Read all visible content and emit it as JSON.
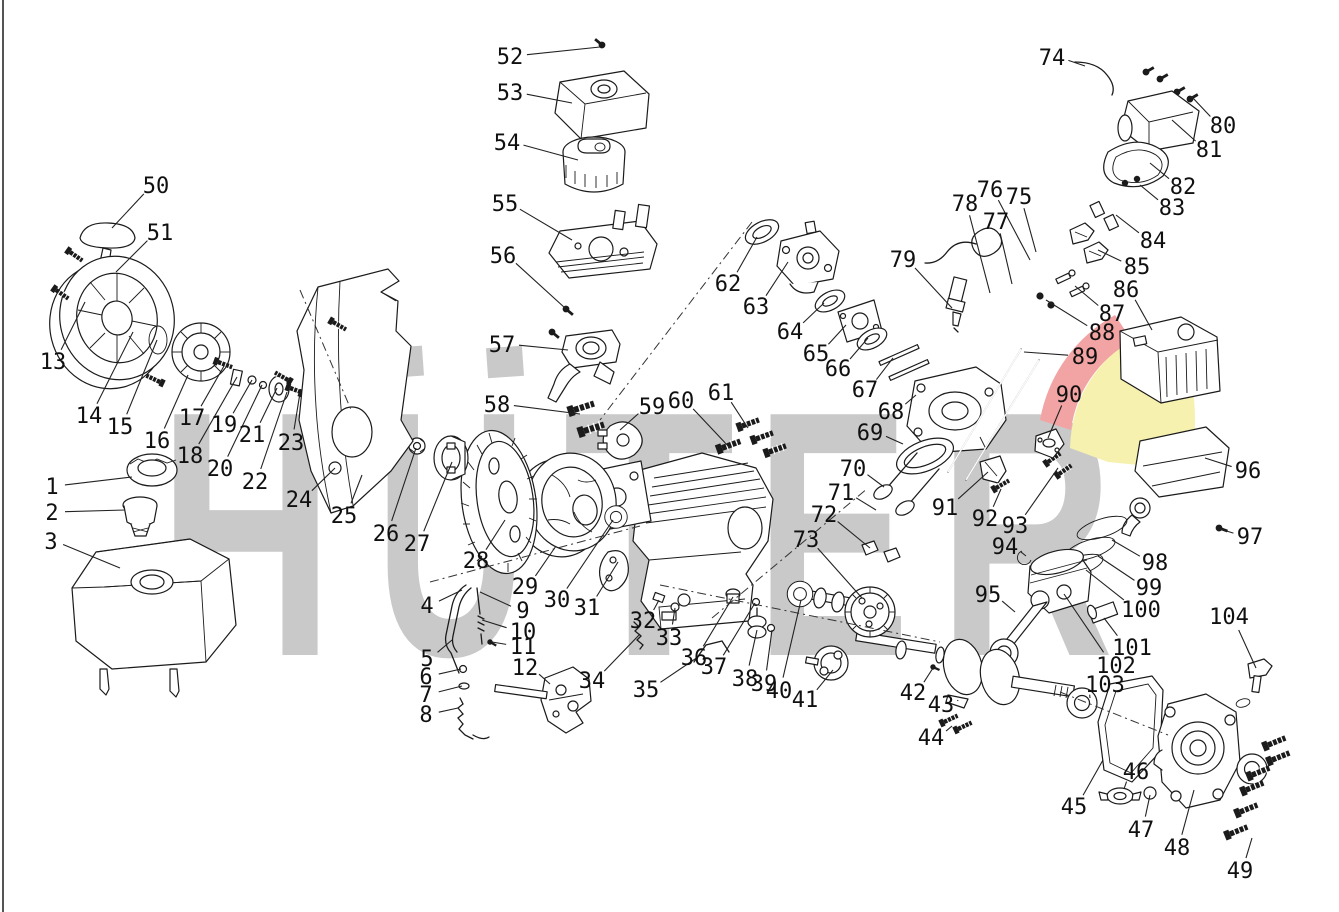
{
  "figure": {
    "type": "exploded-parts-diagram",
    "subject": "engine exploded view with numbered callouts",
    "background": "#ffffff",
    "line_color": "#1b1b1b"
  },
  "watermark": {
    "brand": "HÜTER",
    "letters": [
      "H",
      "U",
      "T",
      "E",
      "R"
    ],
    "letter_color": "#c9c9c9",
    "swoosh_red": "#f2a3a3",
    "swoosh_yellow": "#f6f1ae"
  },
  "diagram": {
    "axis_lines": [
      [
        300,
        290,
        352,
        412
      ],
      [
        752,
        222,
        600,
        420
      ],
      [
        712,
        618,
        868,
        488
      ],
      [
        660,
        585,
        940,
        642
      ],
      [
        1060,
        692,
        1168,
        735
      ],
      [
        430,
        582,
        640,
        526
      ]
    ],
    "callouts": [
      {
        "n": "1",
        "x": 52,
        "y": 486,
        "tx": 132,
        "ty": 477
      },
      {
        "n": "2",
        "x": 52,
        "y": 512,
        "tx": 125,
        "ty": 510
      },
      {
        "n": "3",
        "x": 51,
        "y": 541,
        "tx": 120,
        "ty": 568
      },
      {
        "n": "4",
        "x": 427,
        "y": 605,
        "tx": 462,
        "ty": 590
      },
      {
        "n": "5",
        "x": 427,
        "y": 658,
        "tx": 452,
        "ty": 640
      },
      {
        "n": "6",
        "x": 426,
        "y": 676,
        "tx": 461,
        "ty": 669
      },
      {
        "n": "7",
        "x": 426,
        "y": 694,
        "tx": 462,
        "ty": 686
      },
      {
        "n": "8",
        "x": 426,
        "y": 714,
        "tx": 458,
        "ty": 708
      },
      {
        "n": "9",
        "x": 523,
        "y": 610,
        "tx": 480,
        "ty": 592
      },
      {
        "n": "10",
        "x": 523,
        "y": 631,
        "tx": 482,
        "ty": 620
      },
      {
        "n": "11",
        "x": 523,
        "y": 646,
        "tx": 492,
        "ty": 642
      },
      {
        "n": "12",
        "x": 525,
        "y": 667,
        "tx": 550,
        "ty": 684
      },
      {
        "n": "13",
        "x": 53,
        "y": 361,
        "tx": 85,
        "ty": 302
      },
      {
        "n": "14",
        "x": 89,
        "y": 415,
        "tx": 133,
        "ty": 332
      },
      {
        "n": "15",
        "x": 120,
        "y": 426,
        "tx": 157,
        "ty": 340
      },
      {
        "n": "16",
        "x": 157,
        "y": 440,
        "tx": 188,
        "ty": 375
      },
      {
        "n": "17",
        "x": 192,
        "y": 417,
        "tx": 224,
        "ty": 366
      },
      {
        "n": "18",
        "x": 190,
        "y": 455,
        "tx": 237,
        "ty": 377
      },
      {
        "n": "19",
        "x": 224,
        "y": 424,
        "tx": 252,
        "ty": 380
      },
      {
        "n": "20",
        "x": 220,
        "y": 468,
        "tx": 262,
        "ty": 385
      },
      {
        "n": "21",
        "x": 252,
        "y": 434,
        "tx": 277,
        "ty": 388
      },
      {
        "n": "22",
        "x": 255,
        "y": 481,
        "tx": 287,
        "ty": 392
      },
      {
        "n": "23",
        "x": 291,
        "y": 442,
        "tx": 300,
        "ty": 393
      },
      {
        "n": "24",
        "x": 299,
        "y": 499,
        "tx": 335,
        "ty": 468
      },
      {
        "n": "25",
        "x": 344,
        "y": 515,
        "tx": 362,
        "ty": 475
      },
      {
        "n": "26",
        "x": 386,
        "y": 533,
        "tx": 416,
        "ty": 448
      },
      {
        "n": "27",
        "x": 417,
        "y": 543,
        "tx": 452,
        "ty": 462
      },
      {
        "n": "28",
        "x": 476,
        "y": 560,
        "tx": 505,
        "ty": 520
      },
      {
        "n": "29",
        "x": 525,
        "y": 586,
        "tx": 556,
        "ty": 546
      },
      {
        "n": "30",
        "x": 557,
        "y": 599,
        "tx": 613,
        "ty": 520
      },
      {
        "n": "31",
        "x": 587,
        "y": 607,
        "tx": 618,
        "ty": 562
      },
      {
        "n": "32",
        "x": 643,
        "y": 620,
        "tx": 659,
        "ty": 600
      },
      {
        "n": "33",
        "x": 669,
        "y": 637,
        "tx": 675,
        "ty": 608
      },
      {
        "n": "34",
        "x": 592,
        "y": 680,
        "tx": 640,
        "ty": 634
      },
      {
        "n": "35",
        "x": 646,
        "y": 689,
        "tx": 698,
        "ty": 657
      },
      {
        "n": "36",
        "x": 694,
        "y": 657,
        "tx": 733,
        "ty": 597
      },
      {
        "n": "37",
        "x": 714,
        "y": 666,
        "tx": 755,
        "ty": 603
      },
      {
        "n": "38",
        "x": 745,
        "y": 678,
        "tx": 757,
        "ty": 630
      },
      {
        "n": "39",
        "x": 764,
        "y": 683,
        "tx": 772,
        "ty": 630
      },
      {
        "n": "40",
        "x": 779,
        "y": 690,
        "tx": 801,
        "ty": 600
      },
      {
        "n": "41",
        "x": 805,
        "y": 699,
        "tx": 833,
        "ty": 670
      },
      {
        "n": "42",
        "x": 913,
        "y": 692,
        "tx": 933,
        "ty": 668
      },
      {
        "n": "43",
        "x": 941,
        "y": 704,
        "tx": 958,
        "ty": 700
      },
      {
        "n": "44",
        "x": 931,
        "y": 737,
        "tx": 952,
        "ty": 726
      },
      {
        "n": "45",
        "x": 1074,
        "y": 806,
        "tx": 1103,
        "ty": 760
      },
      {
        "n": "46",
        "x": 1136,
        "y": 771,
        "tx": 1124,
        "ty": 789
      },
      {
        "n": "47",
        "x": 1141,
        "y": 829,
        "tx": 1150,
        "ty": 795
      },
      {
        "n": "48",
        "x": 1177,
        "y": 847,
        "tx": 1194,
        "ty": 790
      },
      {
        "n": "49",
        "x": 1240,
        "y": 870,
        "tx": 1252,
        "ty": 838
      },
      {
        "n": "50",
        "x": 156,
        "y": 185,
        "tx": 112,
        "ty": 228
      },
      {
        "n": "51",
        "x": 160,
        "y": 232,
        "tx": 116,
        "ty": 272
      },
      {
        "n": "52",
        "x": 510,
        "y": 56,
        "tx": 600,
        "ty": 47
      },
      {
        "n": "53",
        "x": 510,
        "y": 92,
        "tx": 572,
        "ty": 103
      },
      {
        "n": "54",
        "x": 507,
        "y": 142,
        "tx": 578,
        "ty": 160
      },
      {
        "n": "55",
        "x": 505,
        "y": 203,
        "tx": 572,
        "ty": 240
      },
      {
        "n": "56",
        "x": 503,
        "y": 255,
        "tx": 565,
        "ty": 308
      },
      {
        "n": "57",
        "x": 502,
        "y": 344,
        "tx": 568,
        "ty": 350
      },
      {
        "n": "58",
        "x": 497,
        "y": 404,
        "tx": 580,
        "ty": 414
      },
      {
        "n": "59",
        "x": 652,
        "y": 406,
        "tx": 620,
        "ty": 430
      },
      {
        "n": "60",
        "x": 681,
        "y": 400,
        "tx": 730,
        "ty": 448
      },
      {
        "n": "61",
        "x": 721,
        "y": 392,
        "tx": 748,
        "ty": 428
      },
      {
        "n": "62",
        "x": 728,
        "y": 283,
        "tx": 757,
        "ty": 237
      },
      {
        "n": "63",
        "x": 756,
        "y": 306,
        "tx": 788,
        "ty": 262
      },
      {
        "n": "64",
        "x": 790,
        "y": 331,
        "tx": 824,
        "ty": 303
      },
      {
        "n": "65",
        "x": 816,
        "y": 353,
        "tx": 846,
        "ty": 325
      },
      {
        "n": "66",
        "x": 838,
        "y": 368,
        "tx": 868,
        "ty": 338
      },
      {
        "n": "67",
        "x": 865,
        "y": 389,
        "tx": 893,
        "ty": 358
      },
      {
        "n": "68",
        "x": 891,
        "y": 411,
        "tx": 916,
        "ty": 395
      },
      {
        "n": "69",
        "x": 870,
        "y": 432,
        "tx": 903,
        "ty": 444
      },
      {
        "n": "70",
        "x": 853,
        "y": 468,
        "tx": 884,
        "ty": 487
      },
      {
        "n": "71",
        "x": 841,
        "y": 492,
        "tx": 876,
        "ty": 510
      },
      {
        "n": "72",
        "x": 824,
        "y": 514,
        "tx": 870,
        "ty": 548
      },
      {
        "n": "73",
        "x": 806,
        "y": 539,
        "tx": 862,
        "ty": 598
      },
      {
        "n": "74",
        "x": 1052,
        "y": 57,
        "tx": 1085,
        "ty": 66
      },
      {
        "n": "75",
        "x": 1019,
        "y": 196,
        "tx": 1036,
        "ty": 252
      },
      {
        "n": "76",
        "x": 990,
        "y": 189,
        "tx": 1030,
        "ty": 260
      },
      {
        "n": "77",
        "x": 996,
        "y": 221,
        "tx": 1012,
        "ty": 284
      },
      {
        "n": "78",
        "x": 965,
        "y": 203,
        "tx": 990,
        "ty": 293
      },
      {
        "n": "79",
        "x": 903,
        "y": 259,
        "tx": 952,
        "ty": 308
      },
      {
        "n": "80",
        "x": 1223,
        "y": 125,
        "tx": 1192,
        "ty": 97
      },
      {
        "n": "81",
        "x": 1209,
        "y": 149,
        "tx": 1172,
        "ty": 120
      },
      {
        "n": "82",
        "x": 1183,
        "y": 186,
        "tx": 1150,
        "ty": 163
      },
      {
        "n": "83",
        "x": 1172,
        "y": 207,
        "tx": 1140,
        "ty": 185
      },
      {
        "n": "84",
        "x": 1153,
        "y": 240,
        "tx": 1116,
        "ty": 215
      },
      {
        "n": "85",
        "x": 1137,
        "y": 266,
        "tx": 1098,
        "ty": 250
      },
      {
        "n": "86",
        "x": 1126,
        "y": 289,
        "tx": 1152,
        "ty": 330
      },
      {
        "n": "87",
        "x": 1112,
        "y": 313,
        "tx": 1075,
        "ty": 286
      },
      {
        "n": "88",
        "x": 1102,
        "y": 332,
        "tx": 1046,
        "ty": 300
      },
      {
        "n": "89",
        "x": 1085,
        "y": 356,
        "tx": 1024,
        "ty": 352
      },
      {
        "n": "90",
        "x": 1069,
        "y": 394,
        "tx": 1048,
        "ty": 438
      },
      {
        "n": "91",
        "x": 945,
        "y": 507,
        "tx": 988,
        "ty": 472
      },
      {
        "n": "92",
        "x": 985,
        "y": 518,
        "tx": 1001,
        "ty": 489
      },
      {
        "n": "93",
        "x": 1015,
        "y": 525,
        "tx": 1058,
        "ty": 468
      },
      {
        "n": "94",
        "x": 1005,
        "y": 546,
        "tx": 1026,
        "ty": 556
      },
      {
        "n": "95",
        "x": 988,
        "y": 594,
        "tx": 1015,
        "ty": 612
      },
      {
        "n": "96",
        "x": 1248,
        "y": 470,
        "tx": 1205,
        "ty": 458
      },
      {
        "n": "97",
        "x": 1250,
        "y": 536,
        "tx": 1220,
        "ty": 529
      },
      {
        "n": "98",
        "x": 1155,
        "y": 562,
        "tx": 1112,
        "ty": 540
      },
      {
        "n": "99",
        "x": 1149,
        "y": 587,
        "tx": 1098,
        "ty": 556
      },
      {
        "n": "100",
        "x": 1141,
        "y": 609,
        "tx": 1086,
        "ty": 570
      },
      {
        "n": "101",
        "x": 1132,
        "y": 647,
        "tx": 1104,
        "ty": 618
      },
      {
        "n": "102",
        "x": 1116,
        "y": 665,
        "tx": 1064,
        "ty": 594
      },
      {
        "n": "103",
        "x": 1105,
        "y": 684,
        "tx": 1090,
        "ty": 698
      },
      {
        "n": "104",
        "x": 1229,
        "y": 616,
        "tx": 1256,
        "ty": 668
      }
    ]
  }
}
